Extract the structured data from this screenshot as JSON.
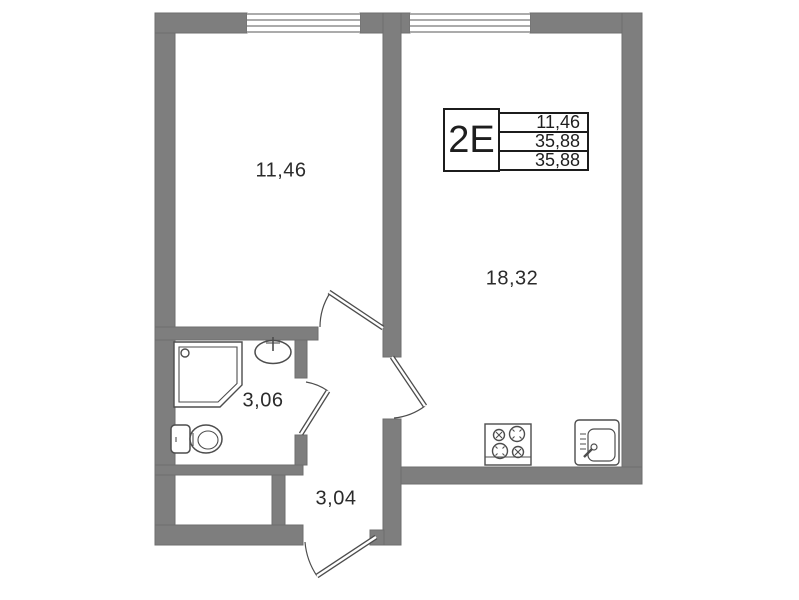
{
  "plan": {
    "title": "apartment-floor-plan",
    "type_label": "2Е",
    "info_table": {
      "rows": [
        "11,46",
        "35,88",
        "35,88"
      ]
    },
    "rooms": [
      {
        "id": "living-room",
        "area": "11,46"
      },
      {
        "id": "kitchen-living-room",
        "area": "18,32"
      },
      {
        "id": "bathroom",
        "area": "3,06"
      },
      {
        "id": "hallway",
        "area": "3,04"
      }
    ],
    "fixtures": [
      "shower",
      "washbasin",
      "toilet",
      "stove",
      "kitchen-sink"
    ],
    "colors": {
      "wall": "#7e7e7e",
      "wall_edge": "#6d6d6d",
      "fixture_line": "#4d4d4d",
      "window_line": "#8f8f8f",
      "text": "#2b2b2b",
      "table_border": "#1c1c1c",
      "background": "#ffffff"
    }
  }
}
